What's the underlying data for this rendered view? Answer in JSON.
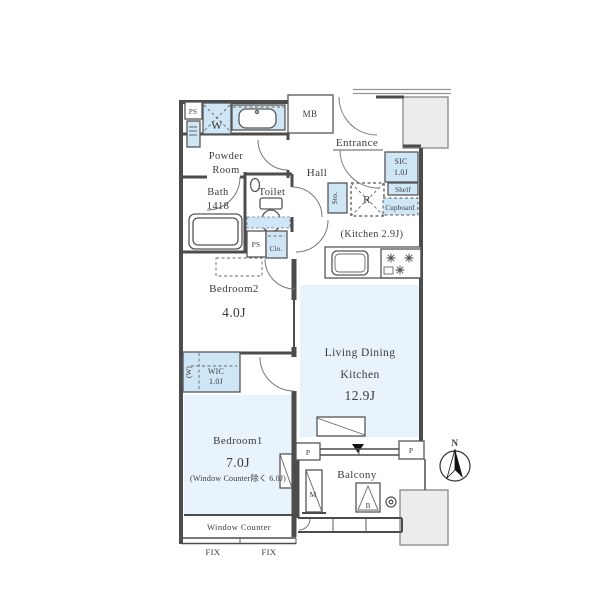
{
  "plan": {
    "utility": {
      "ps": "PS",
      "washer": "W",
      "mb": "MB"
    },
    "powder_room": {
      "name_line1": "Powder",
      "name_line2": "Room"
    },
    "entrance": {
      "name": "Entrance",
      "sic": "SIC",
      "sic_size": "1.0J",
      "shelf": "Shelf",
      "cupboard": "Cupboard"
    },
    "hall": {
      "name": "Hall"
    },
    "bath": {
      "name": "Bath",
      "size": "1418"
    },
    "toilet": {
      "name": "Toilet"
    },
    "storage": {
      "sto": "Sto.",
      "refrigerator": "R",
      "ps": "PS",
      "closet": "Clo."
    },
    "kitchen": {
      "size_note": "(Kitchen 2.9J)"
    },
    "bedroom2": {
      "name": "Bedroom2",
      "size": "4.0J"
    },
    "wic": {
      "name": "WIC",
      "size": "1.0J",
      "w_mark": "(W)"
    },
    "bedroom1": {
      "name": "Bedroom1",
      "size": "7.0J",
      "note": "(Window Counter除く 6.0J)"
    },
    "ldk": {
      "line1": "Living Dining",
      "line2": "Kitchen",
      "size": "12.9J"
    },
    "balcony": {
      "name": "Balcony",
      "m": "M",
      "b": "B"
    },
    "pillars": {
      "left": "P",
      "right": "P"
    },
    "window_counter": {
      "name": "Window Counter",
      "fix_left": "FIX",
      "fix_right": "FIX"
    },
    "compass": {
      "n": "N"
    },
    "colors": {
      "room_fill": "#e8f3fc",
      "fixture_fill": "#cfe6f7",
      "wall": "#4c4c4c",
      "gray_block": "#ebedec",
      "text": "#3b3b3b"
    }
  }
}
